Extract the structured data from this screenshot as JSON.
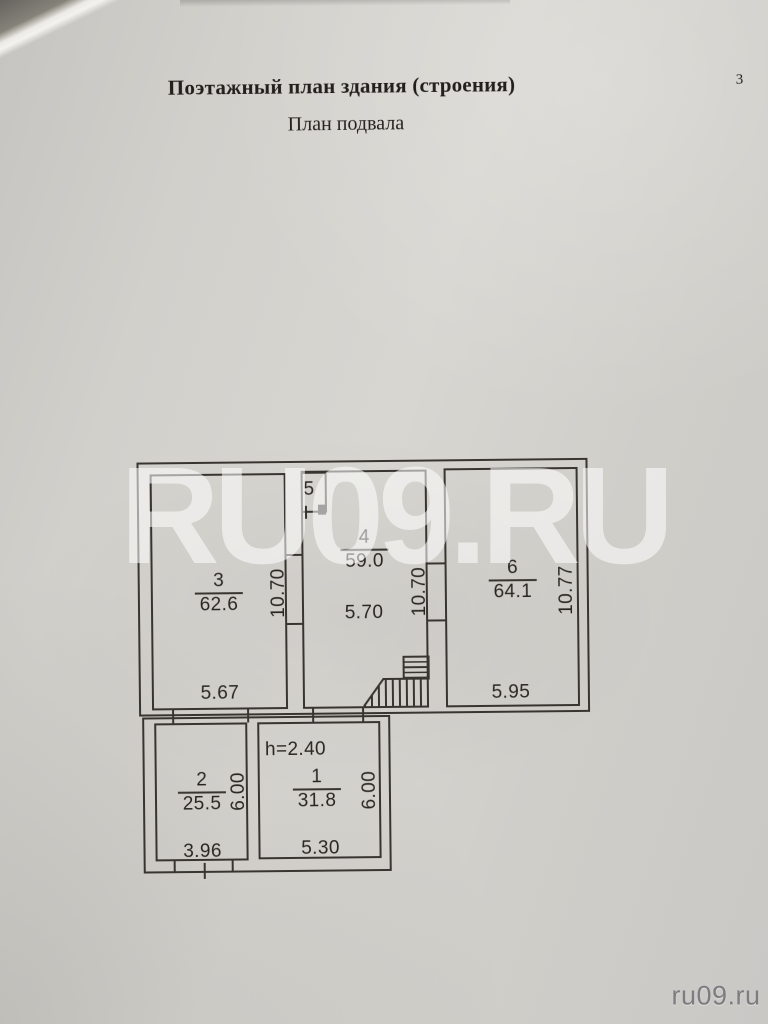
{
  "page": {
    "title": "Поэтажный план здания (строения)",
    "subtitle": "План подвала",
    "page_number": "3"
  },
  "watermark": {
    "large": "RU09.RU",
    "credit": "ru09.ru"
  },
  "plan": {
    "height_note": "h=2.40",
    "rooms": {
      "r1": {
        "number": "1",
        "area": "31.8",
        "width": "5.30",
        "depth": "6.00"
      },
      "r2": {
        "number": "2",
        "area": "25.5",
        "width": "3.96",
        "depth": "6.00"
      },
      "r3": {
        "number": "3",
        "area": "62.6",
        "width": "5.67",
        "depth": "10.70"
      },
      "r4": {
        "number": "4",
        "area": "59.0",
        "width": "5.70",
        "depth": "10.70"
      },
      "r5": {
        "number": "5"
      },
      "r6": {
        "number": "6",
        "area": "64.1",
        "width": "5.95",
        "depth": "10.77"
      }
    }
  },
  "colors": {
    "ink": "#383531",
    "paper": "#d2d0cb"
  }
}
